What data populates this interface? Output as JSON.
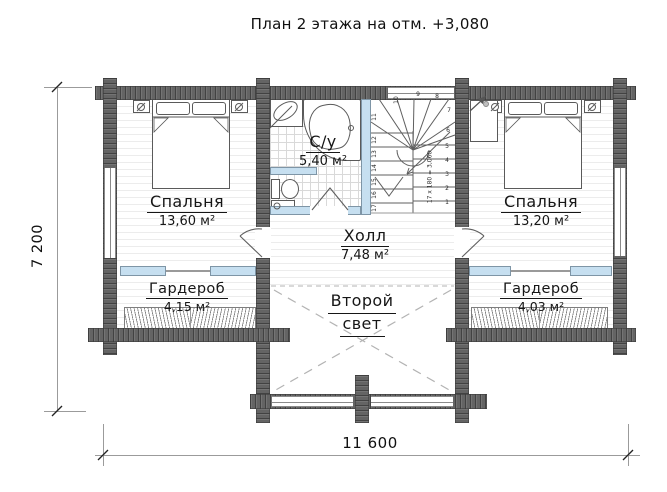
{
  "title": "План 2 этажа на отм. +3,080",
  "dimensions": {
    "vertical": "7 200",
    "horizontal": "11 600"
  },
  "rooms": {
    "bedroom_left": {
      "name": "Спальня",
      "area": "13,60 м²"
    },
    "bathroom": {
      "name": "С/у",
      "area": "5,40 м²"
    },
    "hall": {
      "name": "Холл",
      "area": "7,48 м²"
    },
    "bedroom_right": {
      "name": "Спальня",
      "area": "13,20 м²"
    },
    "wardrobe_left": {
      "name": "Гардероб",
      "area": "4,15 м²"
    },
    "wardrobe_right": {
      "name": "Гардероб",
      "area": "4,03 м²"
    },
    "void": {
      "line1": "Второй",
      "line2": "свет"
    }
  },
  "stairs": {
    "formula": "17 x 180 = 3,060",
    "steps": [
      "1",
      "2",
      "3",
      "4",
      "5",
      "6",
      "7",
      "8",
      "9",
      "10",
      "11",
      "12",
      "13",
      "14",
      "15",
      "16",
      "17"
    ]
  },
  "colors": {
    "wall": "#646464",
    "partition_glass": "#c6dff0",
    "floor_line": "#ececec",
    "tile_line": "#d9d9d9",
    "dash": "#b3b3b3",
    "ink": "#161616"
  }
}
